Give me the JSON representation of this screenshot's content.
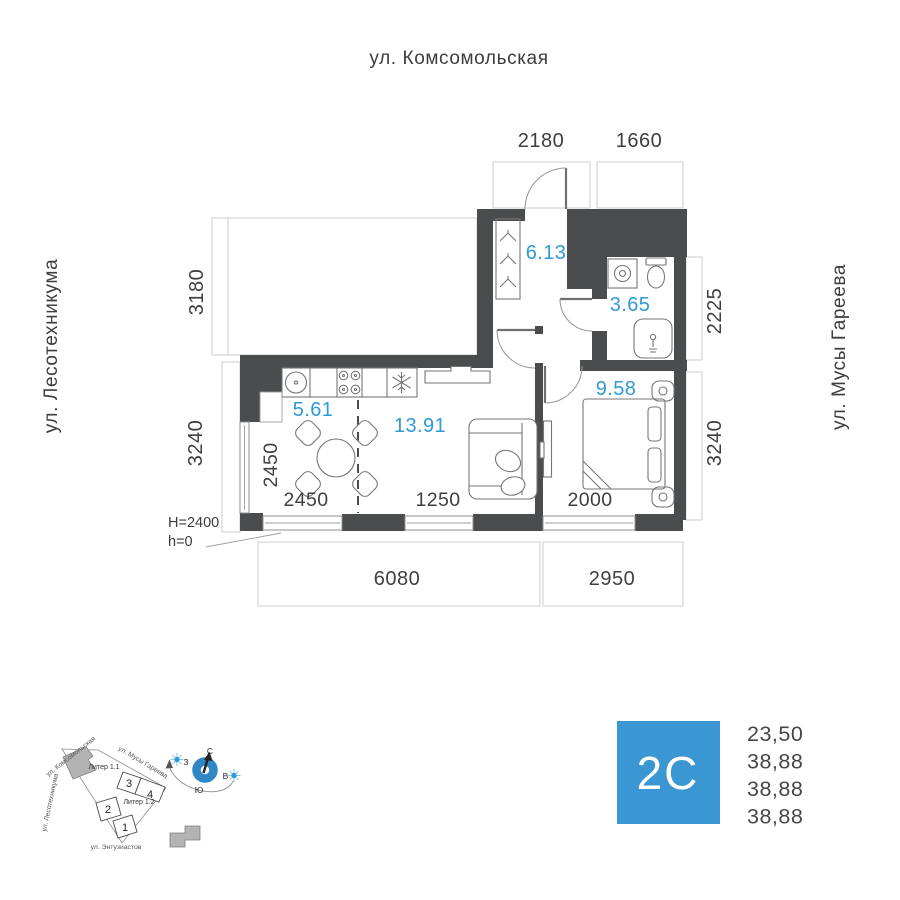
{
  "plan": {
    "streets": {
      "top": "ул. Комсомольская",
      "left": "ул. Лесотехникума",
      "right": "ул. Мусы Гареева"
    },
    "dims": {
      "top_1": "2180",
      "top_2": "1660",
      "left_1": "3180",
      "left_2": "3240",
      "right_1": "2225",
      "right_2": "3240",
      "bottom_1": "6080",
      "bottom_2": "2950",
      "window_left_v": "2450",
      "window_1": "2450",
      "window_2": "1250",
      "window_3": "2000"
    },
    "rooms": {
      "hall": "6.13",
      "bath": "3.65",
      "kitchen": "5.61",
      "living": "13.91",
      "bedroom": "9.58"
    },
    "heights": {
      "ceiling": "H=2400",
      "floor": "h=0"
    }
  },
  "minimap": {
    "streets": {
      "komsomolskaya": "ул. Комсомольская",
      "musa_gareeva": "ул. Мусы Гареева",
      "lesotekhnikuma": "ул. Лесотехникума",
      "entuziastov": "ул. Энтузиастов"
    },
    "buildings": {
      "liter_1_1": "Литер 1.1",
      "liter_1_2": "Литер 1.2"
    },
    "sections": {
      "s1": "1",
      "s2": "2",
      "s3": "3",
      "s4": "4"
    },
    "compass": {
      "north": "С",
      "south": "Ю",
      "west": "З",
      "east": "В"
    }
  },
  "info": {
    "flat_type": "2C",
    "areas": [
      "23,50",
      "38,88",
      "38,88",
      "38,88"
    ]
  },
  "colors": {
    "accent": "#3b97d3",
    "wall": "#4a4c4d",
    "area_text": "#2f9ad6",
    "compass_ring": "#2f87c5"
  }
}
